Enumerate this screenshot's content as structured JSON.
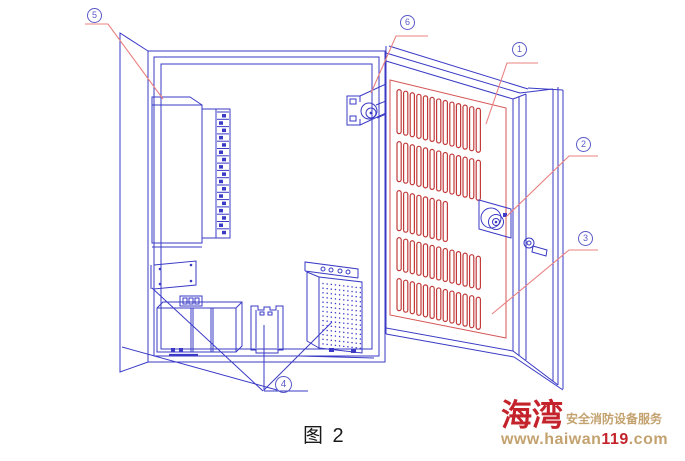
{
  "figure": {
    "caption": "图 2"
  },
  "callouts": {
    "c1": {
      "label": "1"
    },
    "c2": {
      "label": "2"
    },
    "c3": {
      "label": "3"
    },
    "c4": {
      "label": "4"
    },
    "c5": {
      "label": "5"
    },
    "c6": {
      "label": "6"
    }
  },
  "watermark": {
    "brand": "海湾",
    "tagline": "安全消防设备服务",
    "url_prefix": "www.haiwan",
    "url_number": "119",
    "url_suffix": ".com"
  },
  "colors": {
    "line_blue": "#3a3ac6",
    "vent_red": "#c23a3a",
    "frame_red": "#d65656",
    "leader_red": "#ea8080",
    "callout_blue": "#5a5ac8",
    "brand_red": "#c4232b",
    "brand_gold": "#c3a26f"
  }
}
